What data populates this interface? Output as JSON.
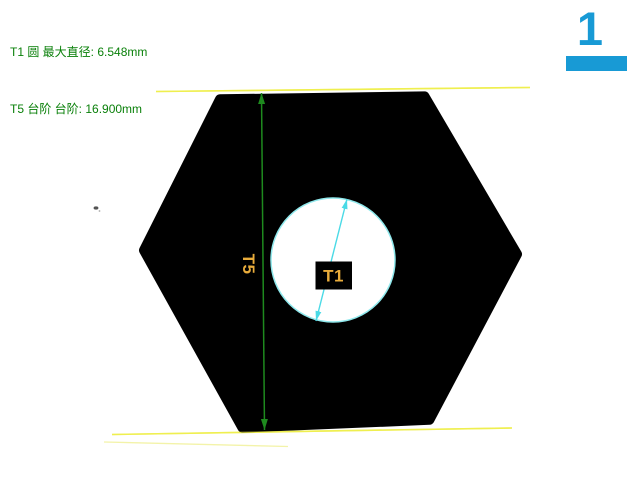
{
  "readouts": [
    {
      "feature_id": "T1",
      "feature_type": "圆",
      "property": "最大直径",
      "value": "6.548mm",
      "text": "T1 圆 最大直径: 6.548mm"
    },
    {
      "feature_id": "T5",
      "feature_type": "台阶",
      "property": "台阶",
      "value": "16.900mm",
      "text": "T5 台阶 台阶: 16.900mm"
    }
  ],
  "page_indicator": {
    "number": "1"
  },
  "feature_labels": {
    "t1": "T1",
    "t5": "T5"
  },
  "colors": {
    "readout_green": "#0a800a",
    "dimension_green": "#1e8a1e",
    "edge_yellow": "#efef4f",
    "measure_cyan": "#4adae6",
    "circle_outline_cyan": "#8fe8ec",
    "label_amber": "#e9ac3b",
    "accent_blue": "#189ad5",
    "silhouette_black": "#000000",
    "background": "#ffffff"
  }
}
